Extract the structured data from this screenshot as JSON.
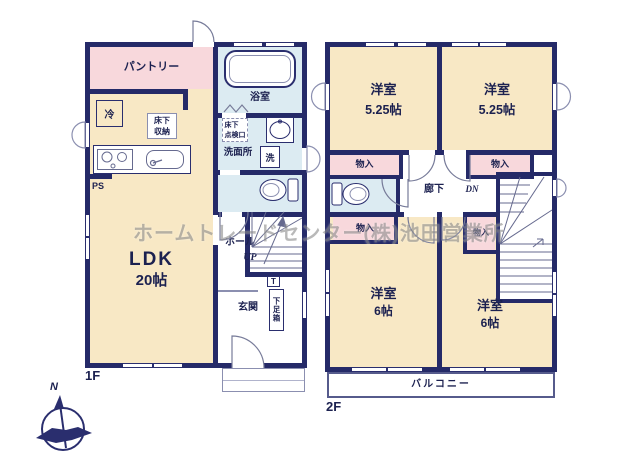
{
  "colors": {
    "wall": "#252a68",
    "room_cream": "#f8e8c5",
    "closet_pink": "#f8d8dc",
    "water_blue": "#dcebf2",
    "watermark_gray": "#8f8f8f"
  },
  "watermark": {
    "text": "ホームトレードセンター(株)池田営業所"
  },
  "compass": {
    "north_label": "N"
  },
  "floor1": {
    "floor_label": "1F",
    "pantry_label": "パントリー",
    "fridge_label": "冷",
    "underfloor_storage_label": "床下\n収納",
    "ps_label": "PS",
    "ldk_name": "LDK",
    "ldk_size": "20帖",
    "bath_label": "浴室",
    "inspection_hatch_label": "床下\n点検口",
    "washroom_label": "洗面所",
    "washer_label": "洗",
    "hall_label": "ホール",
    "up_label": "UP",
    "entrance_label": "玄関",
    "shoebox_t_label": "T",
    "shoebox_label": "下足箱"
  },
  "floor2": {
    "floor_label": "2F",
    "room_nw_name": "洋室",
    "room_nw_size": "5.25帖",
    "room_ne_name": "洋室",
    "room_ne_size": "5.25帖",
    "room_sw_name": "洋室",
    "room_sw_size": "6帖",
    "room_se_name": "洋室",
    "room_se_size": "6帖",
    "closet_nw_label": "物入",
    "closet_ne_label": "物入",
    "closet_sw_label": "物入",
    "closet_center_label": "物入",
    "corridor_label": "廊下",
    "down_label": "DN",
    "balcony_label": "バルコニー"
  }
}
